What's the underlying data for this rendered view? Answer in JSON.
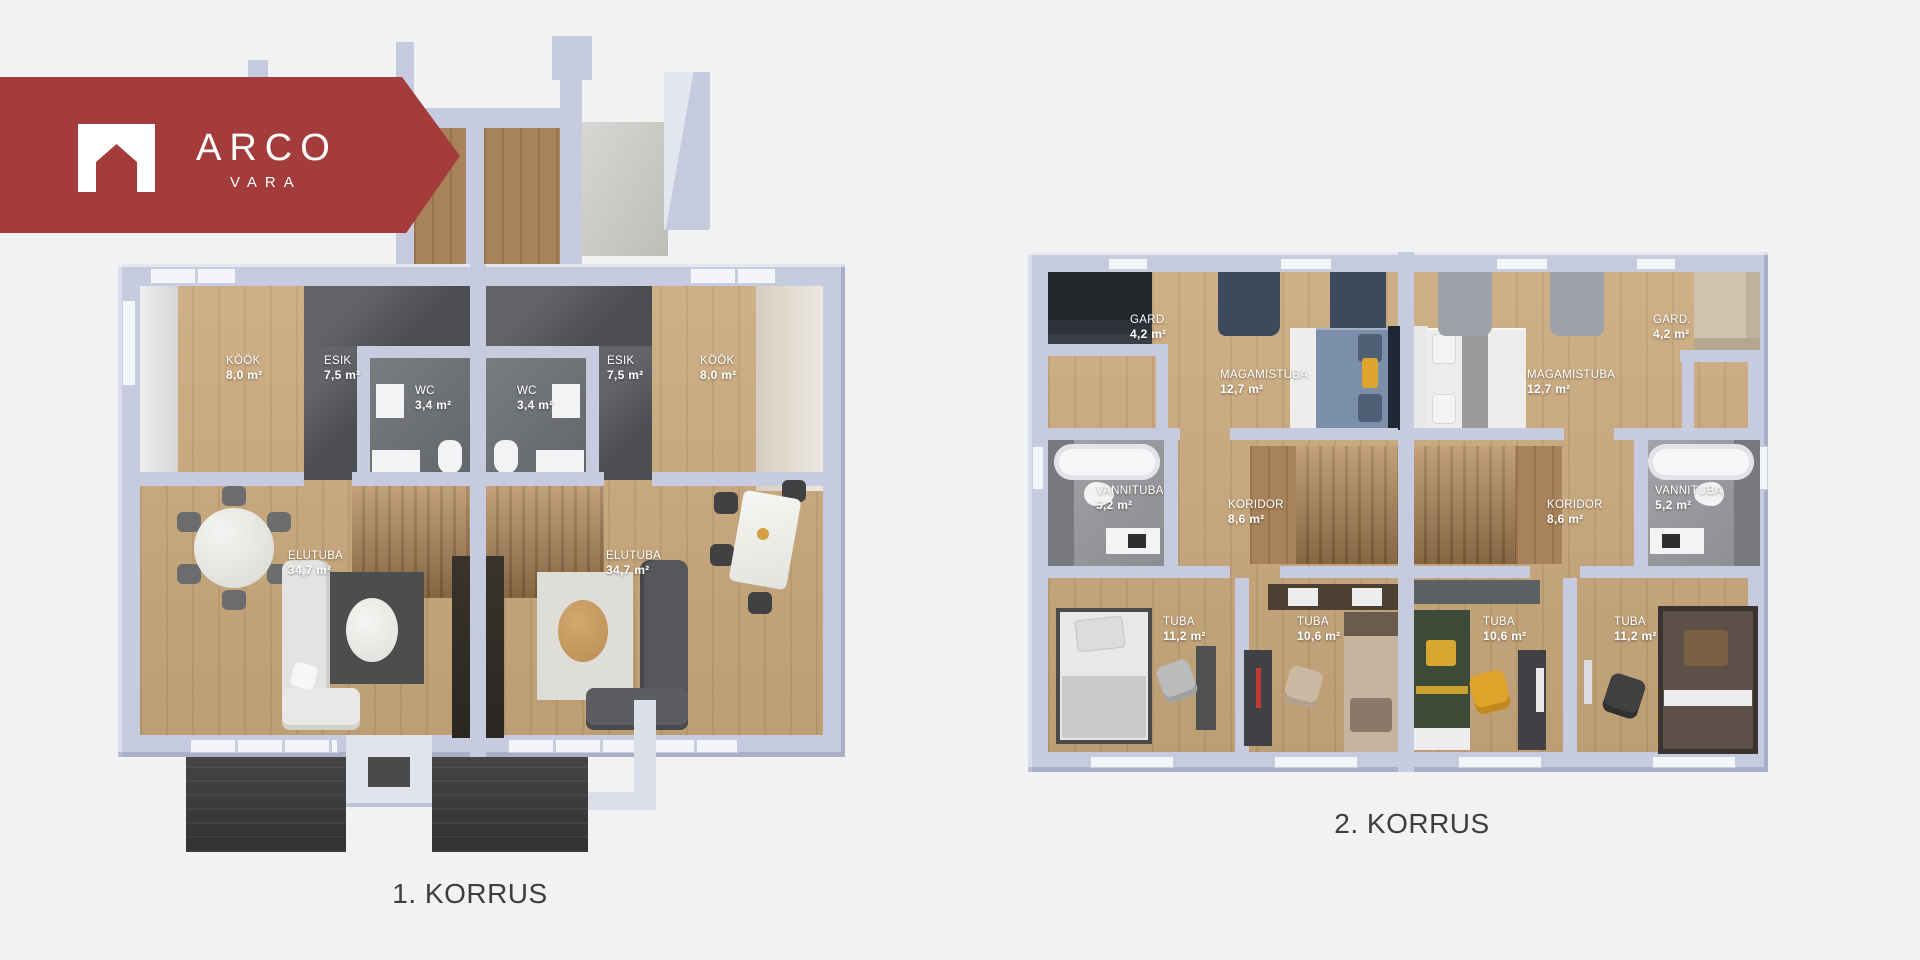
{
  "logo": {
    "brand": "ARCO",
    "sub": "VARA"
  },
  "floor1": {
    "caption": "1. KORRUS",
    "rooms": [
      {
        "name": "KÖÖK",
        "area": "8,0 m²"
      },
      {
        "name": "ESIK",
        "area": "7,5 m²"
      },
      {
        "name": "WC",
        "area": "3,4 m²"
      },
      {
        "name": "WC",
        "area": "3,4 m²"
      },
      {
        "name": "ESIK",
        "area": "7,5 m²"
      },
      {
        "name": "KÖÖK",
        "area": "8,0 m²"
      },
      {
        "name": "ELUTUBA",
        "area": "34,7 m²"
      },
      {
        "name": "ELUTUBA",
        "area": "34,7 m²"
      }
    ]
  },
  "floor2": {
    "caption": "2. KORRUS",
    "rooms": [
      {
        "name": "GARD.",
        "area": "4,2 m²"
      },
      {
        "name": "MAGAMISTUBA",
        "area": "12,7 m²"
      },
      {
        "name": "MAGAMISTUBA",
        "area": "12,7 m²"
      },
      {
        "name": "GARD.",
        "area": "4,2 m²"
      },
      {
        "name": "VANNITUBA",
        "area": "5,2 m²"
      },
      {
        "name": "KORIDOR",
        "area": "8,6 m²"
      },
      {
        "name": "KORIDOR",
        "area": "8,6 m²"
      },
      {
        "name": "VANNITUBA",
        "area": "5,2 m²"
      },
      {
        "name": "TUBA",
        "area": "11,2 m²"
      },
      {
        "name": "TUBA",
        "area": "10,6 m²"
      },
      {
        "name": "TUBA",
        "area": "10,6 m²"
      },
      {
        "name": "TUBA",
        "area": "11,2 m²"
      }
    ]
  },
  "palette": {
    "brand_red": "#A33C3A",
    "page_bg": "#F2F2F4",
    "wall": "#C7CBE0",
    "wall_light": "#DFE2EE",
    "wall_dark": "#AFB4CC",
    "wood": "#C9A77A",
    "wood_dark": "#A8825A",
    "tile_dark": "#56585C",
    "tile_mid": "#6E7175",
    "tile_light": "#97999C",
    "terrace": "#3A3A3C",
    "caption": "#3E3E41",
    "label_text": "#FFFFFF"
  }
}
